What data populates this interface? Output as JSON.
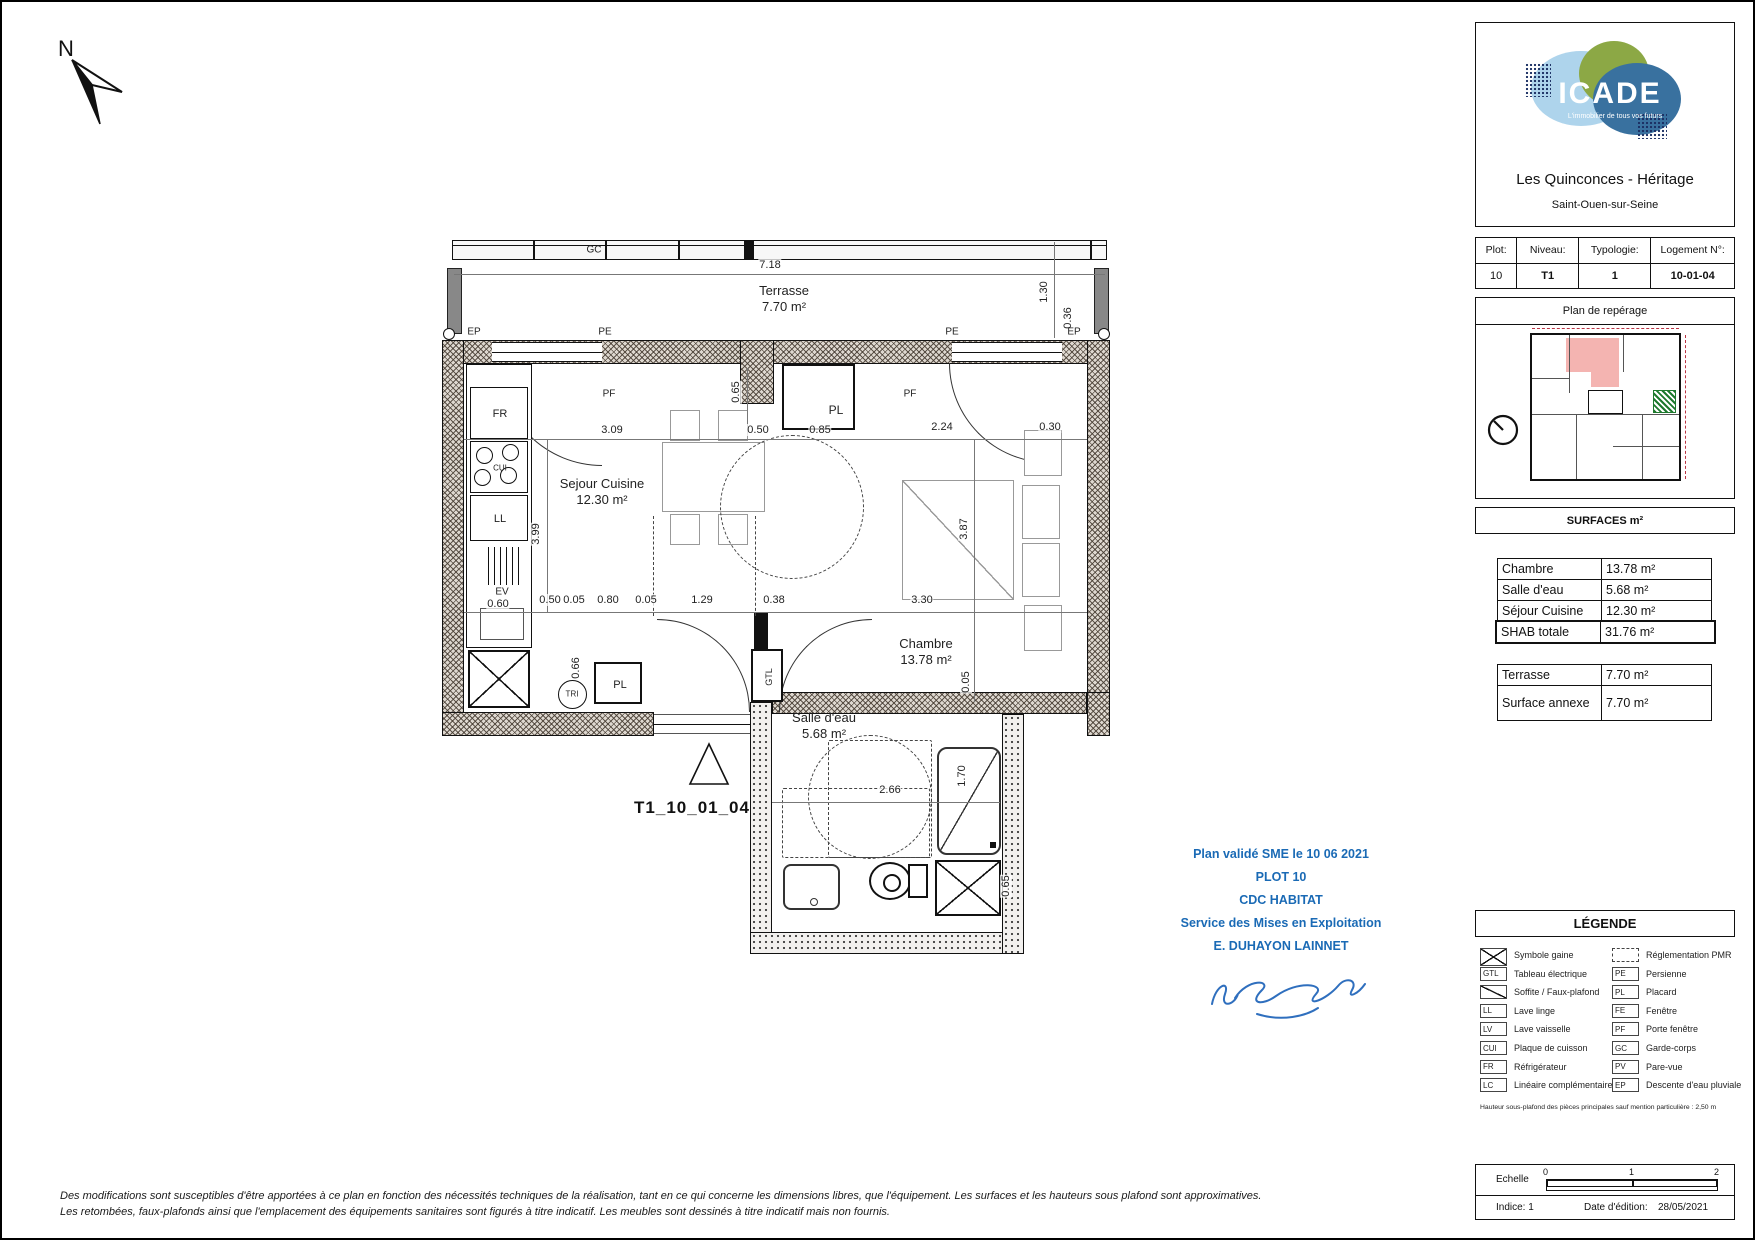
{
  "header": {
    "logo_text": "ICADE",
    "logo_tagline": "L'immobilier de tous vos futurs",
    "project": "Les Quinconces - Héritage",
    "city": "Saint-Ouen-sur-Seine"
  },
  "info_table": {
    "headers": [
      "Plot:",
      "Niveau:",
      "Typologie:",
      "Logement N°:"
    ],
    "values": [
      "10",
      "T1",
      "1",
      "10-01-04"
    ]
  },
  "reperage": {
    "title": "Plan de repérage"
  },
  "surfaces": {
    "title": "SURFACES  m²",
    "rows": [
      {
        "name": "Chambre",
        "value": "13.78 m²"
      },
      {
        "name": "Salle d'eau",
        "value": "5.68 m²"
      },
      {
        "name": "Séjour Cuisine",
        "value": "12.30 m²"
      }
    ],
    "total": {
      "name": "SHAB totale",
      "value": "31.76 m²"
    },
    "annexe_rows": [
      {
        "name": "Terrasse",
        "value": "7.70 m²"
      },
      {
        "name": "Surface annexe",
        "value": "7.70 m²"
      }
    ]
  },
  "legend": {
    "title": "LÉGENDE",
    "left": [
      {
        "sym": "x",
        "code": "",
        "label": "Symbole gaine"
      },
      {
        "sym": "code",
        "code": "GTL",
        "label": "Tableau électrique"
      },
      {
        "sym": "slash",
        "code": "",
        "label": "Soffite / Faux-plafond"
      },
      {
        "sym": "code",
        "code": "LL",
        "label": "Lave linge"
      },
      {
        "sym": "code",
        "code": "LV",
        "label": "Lave vaisselle"
      },
      {
        "sym": "code",
        "code": "CUI",
        "label": "Plaque de cuisson"
      },
      {
        "sym": "code",
        "code": "FR",
        "label": "Réfrigérateur"
      },
      {
        "sym": "code",
        "code": "LC",
        "label": "Linéaire complémentaire"
      }
    ],
    "right": [
      {
        "sym": "dash",
        "code": "",
        "label": "Réglementation PMR"
      },
      {
        "sym": "code",
        "code": "PE",
        "label": "Persienne"
      },
      {
        "sym": "code",
        "code": "PL",
        "label": "Placard"
      },
      {
        "sym": "code",
        "code": "FE",
        "label": "Fenêtre"
      },
      {
        "sym": "code",
        "code": "PF",
        "label": "Porte fenêtre"
      },
      {
        "sym": "code",
        "code": "GC",
        "label": "Garde-corps"
      },
      {
        "sym": "code",
        "code": "PV",
        "label": "Pare-vue"
      },
      {
        "sym": "code",
        "code": "EP",
        "label": "Descente d'eau pluviale"
      }
    ],
    "footnote": "Hauteur sous-plafond des pièces principales sauf mention particulière : 2,50 m"
  },
  "scalebox": {
    "label": "Echelle",
    "ticks": [
      "0",
      "1",
      "2"
    ],
    "indice": "Indice: 1",
    "edition_label": "Date d'édition:",
    "edition_date": "28/05/2021"
  },
  "stamp": {
    "lines": [
      "Plan validé SME le 10 06 2021",
      "PLOT 10",
      "CDC HABITAT",
      "Service des Mises en Exploitation",
      "E. DUHAYON LAINNET"
    ]
  },
  "disclaimer": {
    "line1": "Des modifications sont susceptibles d'être apportées à ce plan en fonction des nécessités techniques de la réalisation, tant en ce qui concerne les dimensions libres, que l'équipement. Les surfaces et les hauteurs sous plafond sont approximatives.",
    "line2": "Les retombées, faux-plafonds ainsi que l'emplacement des équipements sanitaires sont figurés à titre indicatif. Les meubles sont dessinés à titre indicatif mais non fournis."
  },
  "plan": {
    "north_label": "N",
    "unit_label": "T1_10_01_04",
    "codes": {
      "fr": "FR",
      "cui": "CUI",
      "ll": "LL",
      "ev": "EV",
      "tri": "TRI",
      "pl": "PL",
      "gtl": "GTL"
    },
    "rooms": [
      {
        "name": "Terrasse",
        "area": "7.70 m²",
        "x": 782,
        "y": 281
      },
      {
        "name": "Sejour Cuisine",
        "area": "12.30 m²",
        "x": 600,
        "y": 474
      },
      {
        "name": "Chambre",
        "area": "13.78 m²",
        "x": 924,
        "y": 634
      },
      {
        "name": "Salle d'eau",
        "area": "5.68 m²",
        "x": 822,
        "y": 708
      }
    ],
    "float_labels": [
      {
        "t": "GC",
        "x": 592,
        "y": 248
      },
      {
        "t": "EP",
        "x": 472,
        "y": 330
      },
      {
        "t": "EP",
        "x": 1072,
        "y": 330
      },
      {
        "t": "PE",
        "x": 603,
        "y": 330
      },
      {
        "t": "PE",
        "x": 950,
        "y": 330
      },
      {
        "t": "PF",
        "x": 607,
        "y": 392
      },
      {
        "t": "PF",
        "x": 908,
        "y": 392
      }
    ],
    "dim_labels": [
      {
        "t": "7.18",
        "x": 768,
        "y": 263
      },
      {
        "t": "1.30",
        "x": 1042,
        "y": 290,
        "r": 1
      },
      {
        "t": "0.36",
        "x": 1066,
        "y": 316,
        "r": 1
      },
      {
        "t": "3.09",
        "x": 610,
        "y": 428
      },
      {
        "t": "0.50",
        "x": 756,
        "y": 428
      },
      {
        "t": "0.85",
        "x": 818,
        "y": 428
      },
      {
        "t": "2.24",
        "x": 940,
        "y": 425
      },
      {
        "t": "0.30",
        "x": 1048,
        "y": 425
      },
      {
        "t": "0.65",
        "x": 734,
        "y": 390,
        "r": 1
      },
      {
        "t": "3.99",
        "x": 534,
        "y": 532,
        "r": 1
      },
      {
        "t": "3.87",
        "x": 962,
        "y": 527,
        "r": 1
      },
      {
        "t": "0.50",
        "x": 548,
        "y": 598
      },
      {
        "t": "0.05",
        "x": 572,
        "y": 598
      },
      {
        "t": "0.80",
        "x": 606,
        "y": 598
      },
      {
        "t": "0.05",
        "x": 644,
        "y": 598
      },
      {
        "t": "1.29",
        "x": 700,
        "y": 598
      },
      {
        "t": "0.38",
        "x": 772,
        "y": 598
      },
      {
        "t": "3.30",
        "x": 920,
        "y": 598
      },
      {
        "t": "0.05",
        "x": 964,
        "y": 680,
        "r": 1
      },
      {
        "t": "0.66",
        "x": 574,
        "y": 666,
        "r": 1
      },
      {
        "t": "0.60",
        "x": 496,
        "y": 602
      },
      {
        "t": "2.66",
        "x": 888,
        "y": 788
      },
      {
        "t": "1.70",
        "x": 960,
        "y": 774,
        "r": 1
      },
      {
        "t": "0.65",
        "x": 1004,
        "y": 884,
        "r": 1
      }
    ]
  }
}
